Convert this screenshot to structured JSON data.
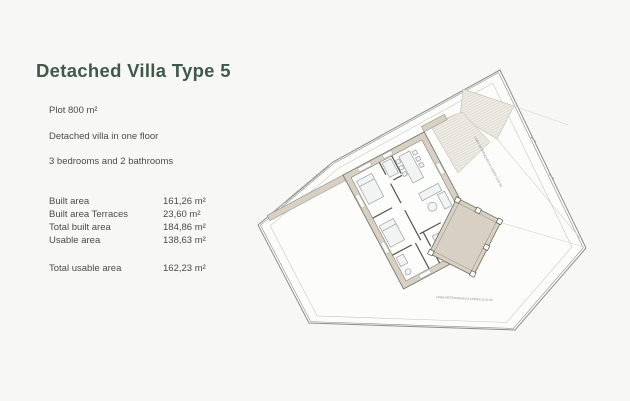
{
  "header": {
    "title": "Detached Villa Type 5"
  },
  "specs": {
    "plot": "Plot 800 m²",
    "floors": "Detached villa in one floor",
    "rooms": "3 bedrooms and 2 bathrooms"
  },
  "areas": {
    "rows": [
      {
        "label": "Built area",
        "value": "161,26 m²"
      },
      {
        "label": "Built area Terraces",
        "value": "23,60 m²"
      },
      {
        "label": "Total built area",
        "value": "184,86 m²"
      },
      {
        "label": "Usable area",
        "value": "138,63 m²"
      }
    ],
    "total": {
      "label": "Total usable area",
      "value": "162,23 m²"
    }
  },
  "plan": {
    "setback_label": "LINEA RETRANQUEO A LINDES (3,00 M)"
  },
  "colors": {
    "title-color": "#3f5a49",
    "text-color": "#4b4b47",
    "page-bg": "#f7f7f5",
    "plan-line": "#8e8e86",
    "wall-fill": "#d8d1c3"
  }
}
